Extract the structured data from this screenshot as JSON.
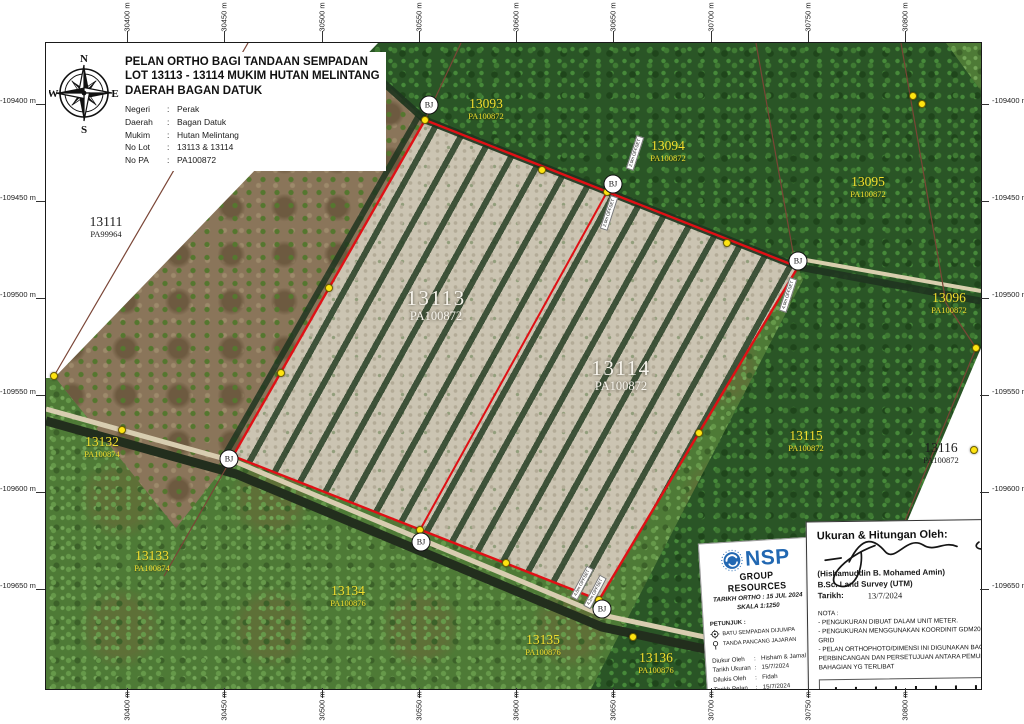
{
  "title_block": {
    "line1": "PELAN ORTHO BAGI TANDAAN SEMPADAN",
    "line2": "LOT 13113 - 13114 MUKIM HUTAN MELINTANG",
    "line3": "DAERAH BAGAN DATUK",
    "fields": [
      {
        "label": "Negeri",
        "value": "Perak"
      },
      {
        "label": "Daerah",
        "value": "Bagan Datuk"
      },
      {
        "label": "Mukim",
        "value": "Hutan Melintang"
      },
      {
        "label": "No Lot",
        "value": "13113 & 13114"
      },
      {
        "label": "No PA",
        "value": "PA100872"
      }
    ]
  },
  "compass": {
    "n": "N",
    "e": "E",
    "s": "S",
    "w": "W"
  },
  "axes": {
    "top": [
      "30400 m",
      "30450 m",
      "30500 m",
      "30550 m",
      "30600 m",
      "30650 m",
      "30700 m",
      "30750 m",
      "30800 m"
    ],
    "bottom": [
      "30400 m",
      "30450 m",
      "30500 m",
      "30550 m",
      "30600 m",
      "30650 m",
      "30700 m",
      "30750 m",
      "30800 m"
    ],
    "left": [
      "-109400 m",
      "-109450 m",
      "-109500 m",
      "-109550 m",
      "-109600 m",
      "-109650 m"
    ],
    "right": [
      "-109400 m",
      "-109450 m",
      "-109500 m",
      "-109550 m",
      "-109600 m",
      "-109650 m"
    ]
  },
  "lots": [
    {
      "num": "13111",
      "pa": "PA99964",
      "cls": "bk",
      "x": 60,
      "y": 172
    },
    {
      "num": "13112",
      "pa": "PA99964",
      "cls": "yl",
      "x": 198,
      "y": 104
    },
    {
      "num": "13093",
      "pa": "PA100872",
      "cls": "yl",
      "x": 440,
      "y": 54
    },
    {
      "num": "13094",
      "pa": "PA100872",
      "cls": "yl",
      "x": 622,
      "y": 96
    },
    {
      "num": "13095",
      "pa": "PA100872",
      "cls": "yl",
      "x": 822,
      "y": 132
    },
    {
      "num": "13096",
      "pa": "PA100872",
      "cls": "yl",
      "x": 903,
      "y": 248
    },
    {
      "num": "13113",
      "pa": "PA100872",
      "cls": "wh",
      "x": 390,
      "y": 244
    },
    {
      "num": "13114",
      "pa": "PA100872",
      "cls": "wh",
      "x": 575,
      "y": 314
    },
    {
      "num": "13115",
      "pa": "PA100872",
      "cls": "yl",
      "x": 760,
      "y": 386
    },
    {
      "num": "13116",
      "pa": "PA100872",
      "cls": "bk",
      "x": 895,
      "y": 398
    },
    {
      "num": "13132",
      "pa": "PA100874",
      "cls": "yl",
      "x": 56,
      "y": 392
    },
    {
      "num": "13133",
      "pa": "PA100874",
      "cls": "yl",
      "x": 106,
      "y": 506
    },
    {
      "num": "13134",
      "pa": "PA100876",
      "cls": "yl",
      "x": 302,
      "y": 541
    },
    {
      "num": "13135",
      "pa": "PA100876",
      "cls": "yl",
      "x": 497,
      "y": 590
    },
    {
      "num": "13136",
      "pa": "PA100876",
      "cls": "yl",
      "x": 610,
      "y": 608
    }
  ],
  "markers": {
    "bj_label": "BJ",
    "bj": [
      {
        "x": 383,
        "y": 62
      },
      {
        "x": 567,
        "y": 141
      },
      {
        "x": 752,
        "y": 218
      },
      {
        "x": 183,
        "y": 416
      },
      {
        "x": 375,
        "y": 499
      },
      {
        "x": 556,
        "y": 566
      }
    ],
    "stones": [
      {
        "x": 379,
        "y": 77
      },
      {
        "x": 496,
        "y": 127
      },
      {
        "x": 561,
        "y": 149
      },
      {
        "x": 681,
        "y": 200
      },
      {
        "x": 752,
        "y": 224
      },
      {
        "x": 653,
        "y": 390
      },
      {
        "x": 553,
        "y": 557
      },
      {
        "x": 460,
        "y": 520
      },
      {
        "x": 374,
        "y": 487
      },
      {
        "x": 187,
        "y": 413
      },
      {
        "x": 283,
        "y": 245
      },
      {
        "x": 235,
        "y": 330
      },
      {
        "x": 8,
        "y": 333
      },
      {
        "x": 76,
        "y": 387
      },
      {
        "x": 930,
        "y": 305
      },
      {
        "x": 928,
        "y": 407
      },
      {
        "x": 867,
        "y": 53
      },
      {
        "x": 876,
        "y": 61
      },
      {
        "x": 587,
        "y": 594
      }
    ],
    "offset_chips": [
      {
        "text": "2.0m OFFSET",
        "x": 589,
        "y": 110,
        "rot": -72
      },
      {
        "text": "2.0m OFFSET",
        "x": 563,
        "y": 170,
        "rot": -72
      },
      {
        "text": "4.0m OFFSET",
        "x": 742,
        "y": 252,
        "rot": -72
      },
      {
        "text": "4.0m OFFSET",
        "x": 536,
        "y": 540,
        "rot": -62
      },
      {
        "text": "4.2m OFFSET",
        "x": 549,
        "y": 549,
        "rot": -62
      }
    ]
  },
  "nsp_card": {
    "brand": "NSP",
    "brand_sub": "GROUP RESOURCES",
    "ortho_date_line": "TARIKH ORTHO : 15 JUL 2024",
    "scale_line": "SKALA 1:1250",
    "legend_title": "PETUNJUK :",
    "legend": [
      {
        "icon": "boundary-stone-icon",
        "label": "BATU SEMPADAN DIJUMPA"
      },
      {
        "icon": "alignment-stake-icon",
        "label": "TANDA PANCANG JAJARAN"
      }
    ],
    "table": [
      {
        "label": "Diukur Oleh",
        "value": "Hisham & Jamal"
      },
      {
        "label": "Tarikh Ukuran",
        "value": "15/7/2024"
      },
      {
        "label": "Dilukis Oleh",
        "value": "Fidah"
      },
      {
        "label": "Tarikh Pelan",
        "value": "15/7/2024"
      },
      {
        "label": "Disemak oleh",
        "value": "Zaidi"
      },
      {
        "label": "No Pelan",
        "value": "NSP/24/13011/FP"
      }
    ]
  },
  "sign_card": {
    "heading": "Ukuran & Hitungan Oleh:",
    "name": "(Hishamuddin B. Mohamed Amin)",
    "qualification": "B.Sc. Land Survey (UTM)",
    "date_label": "Tarikh:",
    "date_value": "13/7/2024",
    "nota_title": "NOTA :",
    "nota": [
      "- PENGUKURAN DIBUAT DALAM UNIT METER.",
      "- PENGUKURAN MENGGUNAKAN KOORDINIT GDM2000 PERAK GRID",
      "- PELAN ORTHOPHOTO/DIMENSI INI DIGUNAKAN BAGI PERBINCANGAN DAN PERSETUJUAN ANTARA PEMUNYA BAHAGIAN YG TERLIBAT"
    ]
  },
  "scalebar": {
    "labels": [
      "0 m",
      "20 m",
      "40 m",
      "60 m",
      "80 m"
    ]
  },
  "colors": {
    "boundary_red": "#e01015",
    "stone_yellow": "#ffe411",
    "lot_label_yellow": "#f2df2f",
    "nsp_blue": "#2268b2"
  }
}
